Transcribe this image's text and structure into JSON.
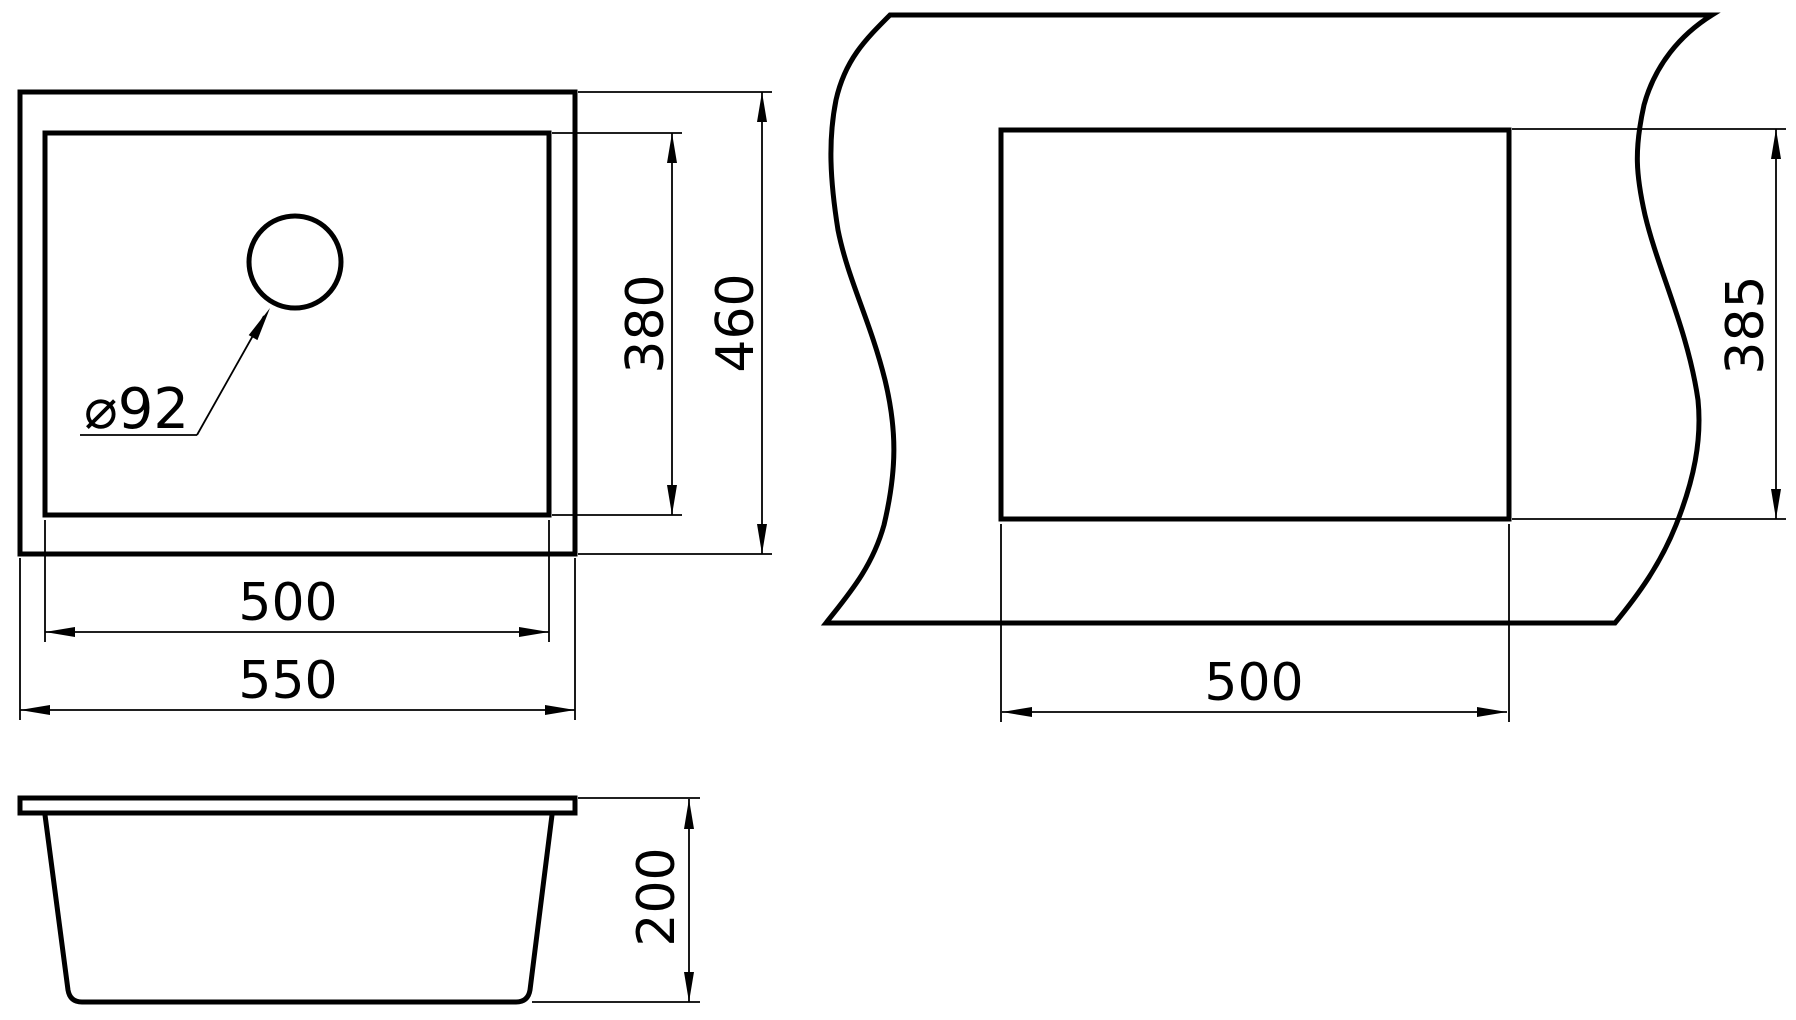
{
  "views": {
    "top": {
      "name": "top view",
      "labels": {
        "inner_width": "500",
        "outer_width": "550",
        "inner_depth": "380",
        "outer_depth": "460",
        "drain": "⌀92"
      }
    },
    "cutout": {
      "name": "countertop cutout template",
      "labels": {
        "width": "500",
        "height": "385"
      }
    },
    "side": {
      "name": "side view",
      "labels": {
        "depth": "200"
      }
    }
  },
  "dimensions_mm": {
    "overall": {
      "width": 550,
      "depth": 460,
      "height": 200
    },
    "bowl": {
      "width": 500,
      "depth": 380
    },
    "drain_diameter": 92,
    "cutout": {
      "width": 500,
      "height": 385
    }
  },
  "colors": {
    "line": "#000000",
    "background": "#ffffff"
  }
}
